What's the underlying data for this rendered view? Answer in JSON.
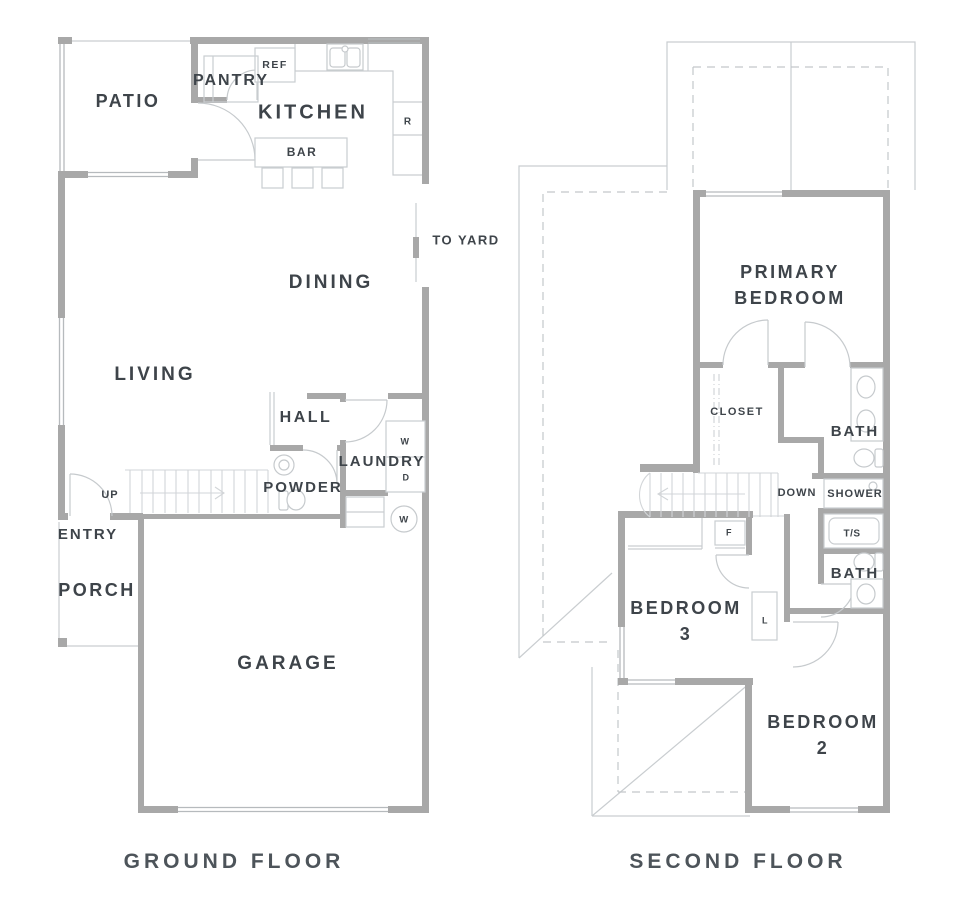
{
  "meta": {
    "drawing_type": "residential floor plan, two storeys side by side",
    "background_color": "#ffffff"
  },
  "colors": {
    "wall": "#a8a8a8",
    "thin_line": "#c9cdd0",
    "window_line": "#b6babd",
    "dashed_line": "#c3c7ca",
    "label_text": "#3e444a",
    "title_text": "#4d545a"
  },
  "ground_floor": {
    "title": "GROUND FLOOR",
    "labels": {
      "patio": "PATIO",
      "pantry": "PANTRY",
      "ref": "REF",
      "kitchen": "KITCHEN",
      "bar": "BAR",
      "range": "R",
      "to_yard": "TO YARD",
      "dining": "DINING",
      "living": "LIVING",
      "hall": "HALL",
      "laundry": "LAUNDRY",
      "washer": "W",
      "dryer": "D",
      "powder": "POWDER",
      "up": "UP",
      "water_heater": "W",
      "entry": "ENTRY",
      "porch": "PORCH",
      "garage": "GARAGE"
    }
  },
  "second_floor": {
    "title": "SECOND FLOOR",
    "labels": {
      "primary_bedroom_line1": "PRIMARY",
      "primary_bedroom_line2": "BEDROOM",
      "closet": "CLOSET",
      "bath_primary": "BATH",
      "down": "DOWN",
      "shower": "SHOWER",
      "tub_shower": "T/S",
      "bath_hall": "BATH",
      "furnace": "F",
      "linen": "L",
      "bedroom3_line1": "BEDROOM",
      "bedroom3_line2": "3",
      "bedroom2_line1": "BEDROOM",
      "bedroom2_line2": "2"
    }
  }
}
